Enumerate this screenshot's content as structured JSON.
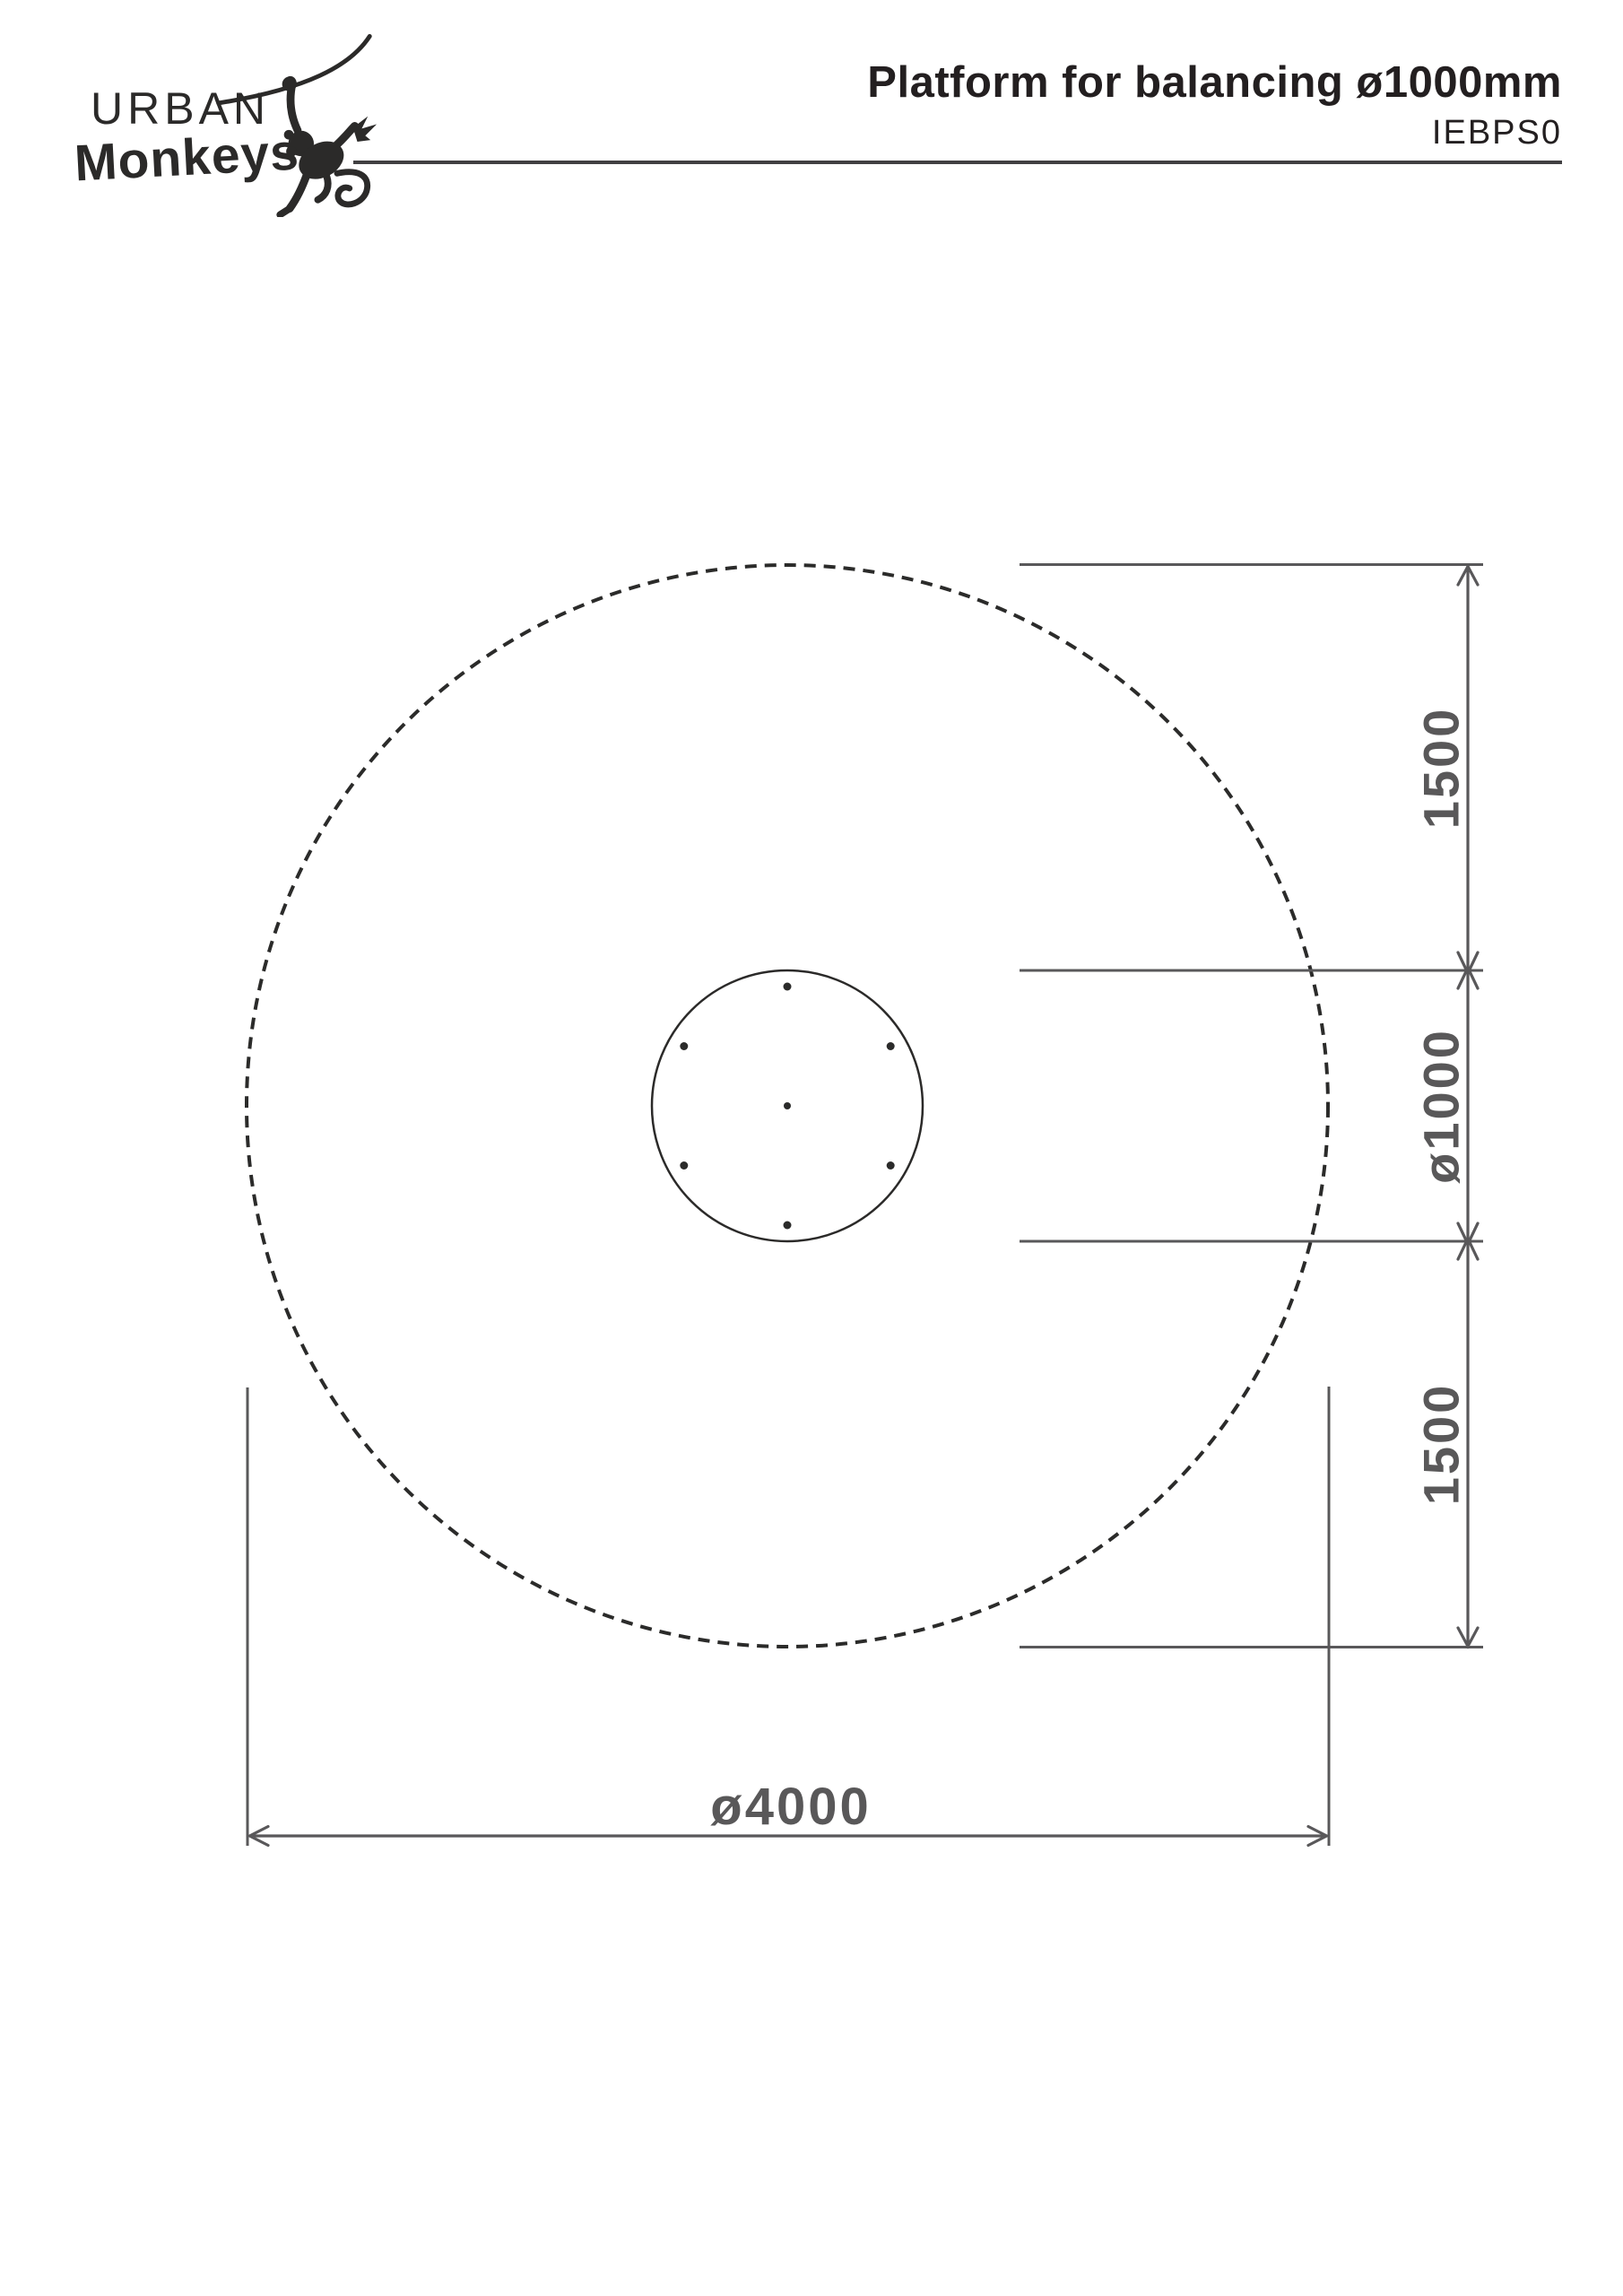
{
  "header": {
    "logo": {
      "top": "URBAN",
      "bottom": "Monkeys"
    },
    "title": "Platform for balancing ø1000mm",
    "code": "IEBPS0"
  },
  "drawing": {
    "dims": {
      "right_top": "1500",
      "right_middle": "ø1000",
      "right_bottom": "1500",
      "bottom_width": "ø4000"
    }
  },
  "colors": {
    "ink_black": "#2b2a29",
    "dimension_gray": "#595859",
    "rule_gray": "#414042"
  }
}
